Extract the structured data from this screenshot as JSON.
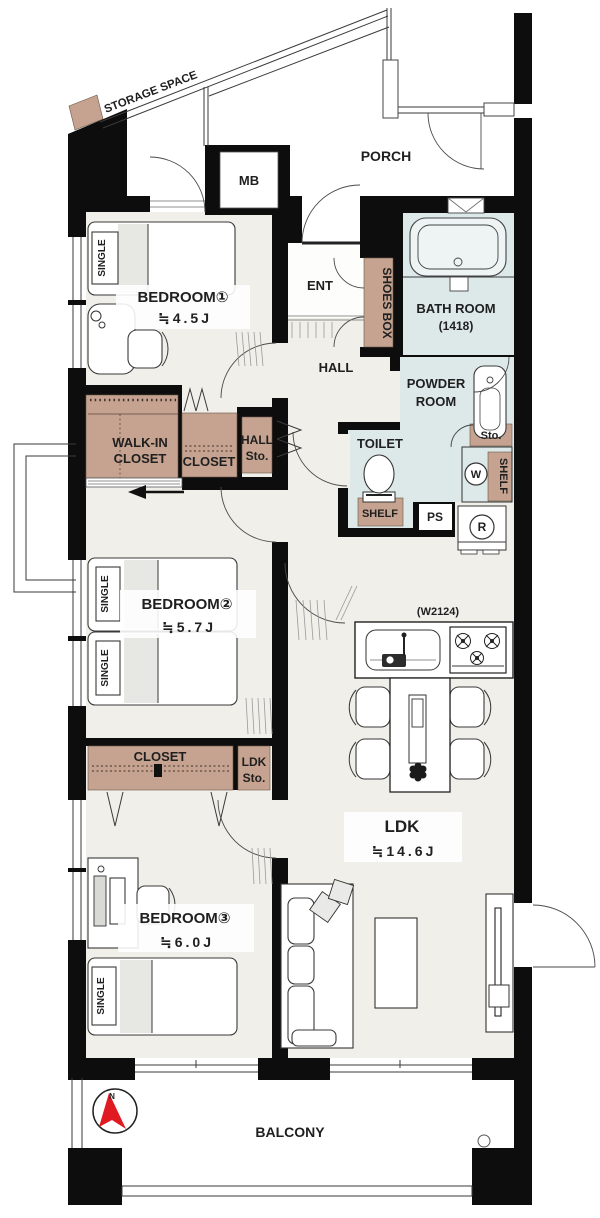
{
  "meta": {
    "type": "apartment-floor-plan"
  },
  "rooms": [
    {
      "name": "BEDROOM①",
      "size": "≒4.5J"
    },
    {
      "name": "BEDROOM②",
      "size": "≒5.7J"
    },
    {
      "name": "BEDROOM③",
      "size": "≒6.0J"
    },
    {
      "name": "LDK",
      "size": "≒14.6J"
    }
  ],
  "areas": {
    "porch": "PORCH",
    "ent": "ENT",
    "hall": "HALL",
    "balcony": "BALCONY",
    "toilet": "TOILET",
    "storage_space": "STORAGE SPACE",
    "mb": "MB",
    "bath": {
      "name": "BATH ROOM",
      "size": "(1418)"
    },
    "powder": {
      "line1": "POWDER",
      "line2": "ROOM"
    }
  },
  "storage": {
    "walk_in_closet": {
      "line1": "WALK-IN",
      "line2": "CLOSET"
    },
    "closet_b1": "CLOSET",
    "closet_b3": "CLOSET",
    "hall_sto": {
      "line1": "HALL",
      "line2": "Sto."
    },
    "ldk_sto": {
      "line1": "LDK",
      "line2": "Sto."
    },
    "shoes_box": "SHOES BOX",
    "shelf_toilet": "SHELF",
    "shelf_powder": "SHELF",
    "sto_powder": "Sto."
  },
  "fixtures": {
    "washer": "W",
    "fridge": "R",
    "ps": "PS",
    "kitchen_width": "(W2124)"
  },
  "beds": {
    "label": "SINGLE"
  },
  "compass": {
    "north": "N"
  },
  "colors": {
    "wall": "#0d0d0d",
    "floor": "#f1efe9",
    "wet_room": "#dde8e8",
    "closet": "#c6a390",
    "compass_red": "#e11a22"
  }
}
